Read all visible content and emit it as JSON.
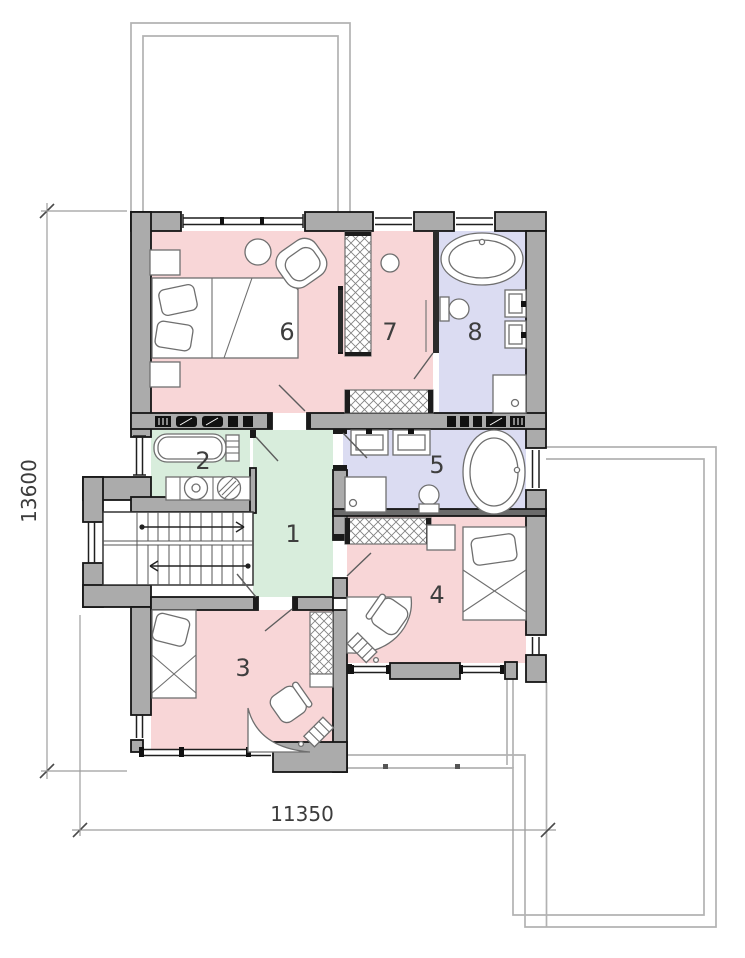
{
  "title": "second-floor-plan",
  "dimensions": {
    "height": {
      "value": "13600"
    },
    "width": {
      "value": "11350"
    }
  },
  "rooms": {
    "r1": {
      "label": "1"
    },
    "r2": {
      "label": "2"
    },
    "r3": {
      "label": "3"
    },
    "r4": {
      "label": "4"
    },
    "r5": {
      "label": "5"
    },
    "r6": {
      "label": "6"
    },
    "r7": {
      "label": "7"
    },
    "r8": {
      "label": "8"
    }
  },
  "colors": {
    "bedroom_pink": "#f8d6d7",
    "hall_green": "#d8eddc",
    "bath_lavender": "#dbdcf2",
    "wall_gray": "#ababab"
  },
  "icons": {
    "double_bed": "double-bed-icon",
    "single_bed": "single-bed-icon",
    "armchair": "armchair-icon",
    "round_table": "round-table-icon",
    "bathtub": "bathtub-icon",
    "oval_bathtub": "oval-bathtub-icon",
    "sink": "sink-icon",
    "toilet": "toilet-icon",
    "shower": "shower-icon",
    "washing_machine": "washing-machine-icon",
    "dryer": "dryer-icon",
    "wardrobe": "wardrobe-hatch-icon",
    "desk": "desk-icon",
    "desk_chair": "desk-chair-icon",
    "shelf": "shelf-icon",
    "stairs": "stairs-icon"
  }
}
